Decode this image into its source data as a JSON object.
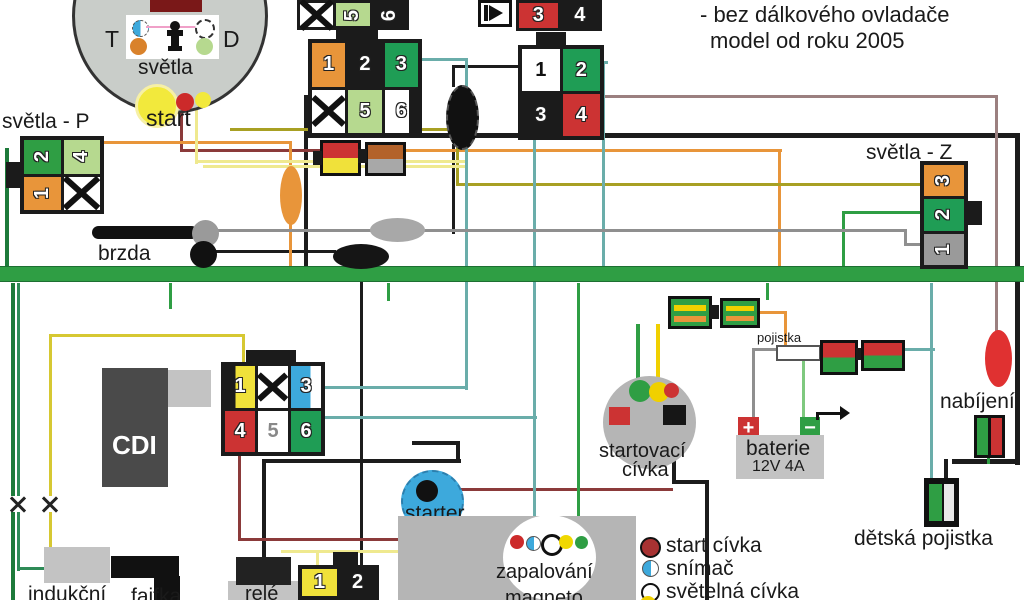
{
  "colors": {
    "bus_green": "#2f9e44",
    "connector_black": "#1b1b1b",
    "orange": "#e8953a",
    "red": "#cc3333",
    "yellow": "#f0e13a",
    "light_green": "#b6d98f",
    "blue": "#3da9dc",
    "teal": "#6aadaa",
    "gray": "#8f8f8f",
    "dark_red": "#8b3a3a",
    "rosy_brown": "#9b8080",
    "olive": "#a8a023"
  },
  "header": {
    "title_line1": "- bez dálkového ovladače",
    "title_line2": "model od roku 2005"
  },
  "ignition": {
    "panel_left": "T",
    "panel_right": "D",
    "lights_label": "světla",
    "start_label": "start"
  },
  "front_lights": {
    "label": "světla - P",
    "pins": [
      "2",
      "4",
      "1",
      "✕"
    ]
  },
  "rear_lights": {
    "label": "světla - Z",
    "pins": [
      "3",
      "2",
      "1"
    ]
  },
  "brake": {
    "label": "brzda"
  },
  "connectors": {
    "top_left_pins": [
      "✕",
      "5",
      "6"
    ],
    "top_right_pins": [
      "3",
      "4"
    ],
    "handlebar_pins": [
      "1",
      "2",
      "3",
      "✕",
      "5",
      "6"
    ],
    "key_switch_pins": [
      "1",
      "2",
      "3",
      "4"
    ],
    "cdi_pins": [
      "1",
      "✕",
      "3",
      "4",
      "5",
      "6"
    ],
    "magneto_plug_pins": [
      "1",
      "2"
    ]
  },
  "cdi": {
    "label": "CDI"
  },
  "induction_coil": {
    "label": "indukční"
  },
  "spark_plug_cap": {
    "label": "fajfka"
  },
  "relay": {
    "label": "relé"
  },
  "starter": {
    "label": "starter"
  },
  "magneto": {
    "label_line1": "zapalování",
    "label_line2": "magneto"
  },
  "start_coil": {
    "label_line1": "startovací",
    "label_line2": "cívka"
  },
  "battery": {
    "label": "baterie",
    "spec": "12V 4A",
    "plus": "+",
    "minus": "−"
  },
  "fuse": {
    "label": "pojistka"
  },
  "charging": {
    "label": "nabíjení"
  },
  "child_fuse": {
    "label": "dětská pojistka"
  },
  "legend": {
    "items": [
      {
        "label": "start cívka",
        "dot": "dark-red-circle"
      },
      {
        "label": "snímač",
        "dot": "blue-half-circle"
      },
      {
        "label": "světelná cívka",
        "dot": "white-circle"
      },
      {
        "label": "",
        "dot": "yellow-circle"
      }
    ]
  }
}
